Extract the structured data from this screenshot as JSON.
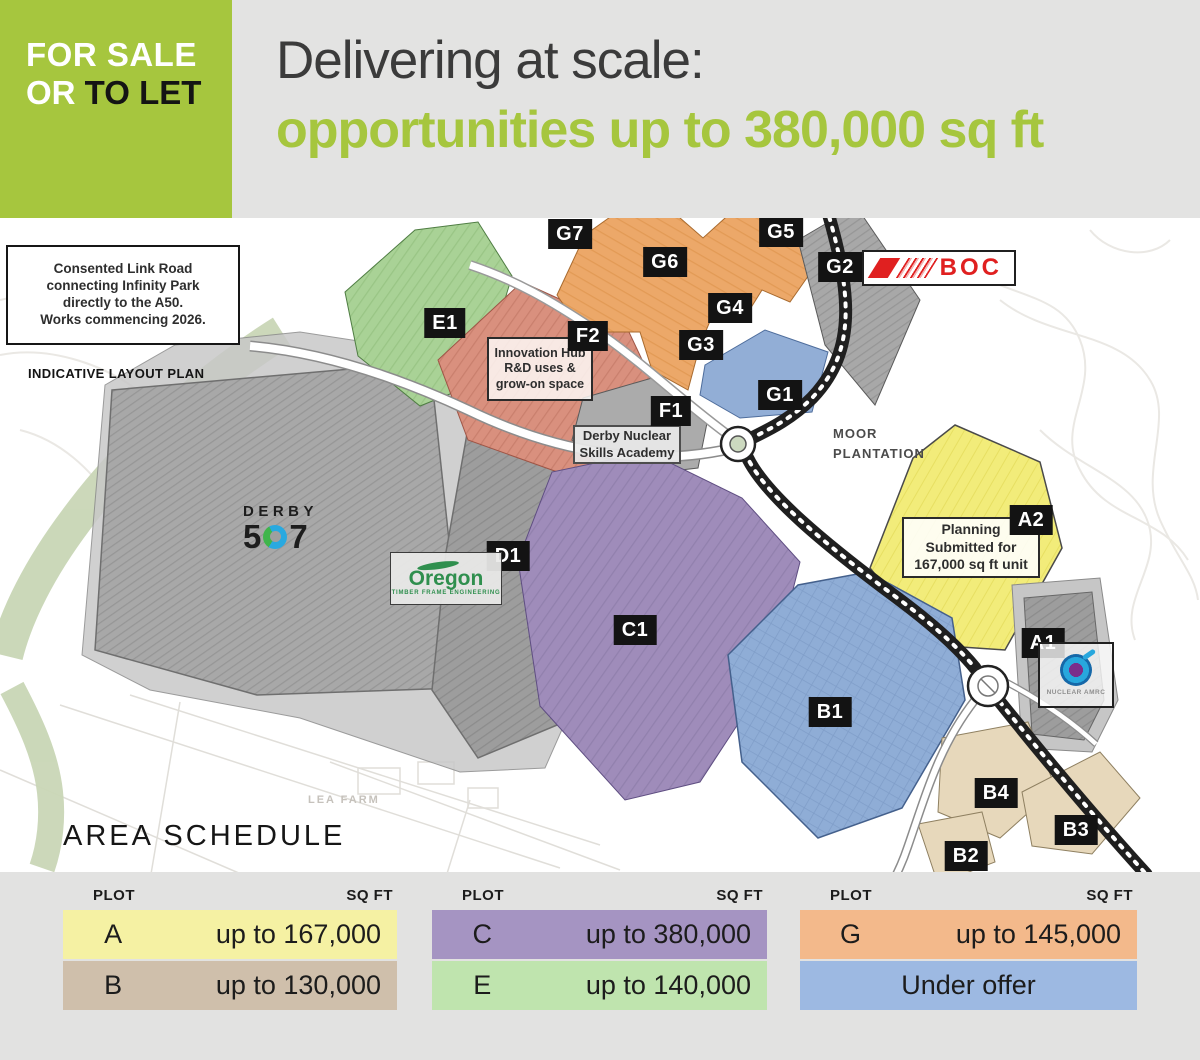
{
  "badge": {
    "for_sale": "FOR SALE",
    "or": "OR",
    "to_let": "TO LET"
  },
  "header": {
    "title": "Delivering at scale:",
    "subtitle": "opportunities up to 380,000 sq ft"
  },
  "map": {
    "note_lines": [
      "Consented Link Road",
      "connecting Infinity Park",
      "directly to the A50.",
      "Works commencing 2026."
    ],
    "plan_type_label": "INDICATIVE LAYOUT PLAN",
    "moor_plantation_lines": [
      "MOOR",
      "PLANTATION"
    ],
    "lea_farm": "LEA FARM",
    "innovation_lines": [
      "Innovation Hub",
      "R&D uses &",
      "grow-on space"
    ],
    "academy_lines": [
      "Derby Nuclear",
      "Skills Academy"
    ],
    "planning_lines": [
      "Planning",
      "Submitted for",
      "167,000 sq ft unit"
    ],
    "plots": {
      "e1": "E1",
      "f1": "F1",
      "f2": "F2",
      "g1": "G1",
      "g2": "G2",
      "g3": "G3",
      "g4": "G4",
      "g5": "G5",
      "g6": "G6",
      "g7": "G7",
      "a1": "A1",
      "a2": "A2",
      "b1": "B1",
      "b2": "B2",
      "b3": "B3",
      "b4": "B4",
      "c1": "C1",
      "d1": "D1"
    },
    "logos": {
      "boc": "BOC",
      "derby_word": "DERBY",
      "derby_5": "5",
      "derby_7": "7",
      "oregon_name": "Oregon",
      "oregon_tagline": "TIMBER FRAME ENGINEERING",
      "amrc_name": "NUCLEAR AMRC"
    }
  },
  "area_schedule": {
    "title": "AREA SCHEDULE",
    "plot_header": "PLOT",
    "sqft_header": "SQ FT",
    "rows": {
      "a": {
        "plot": "A",
        "value": "up to 167,000",
        "color": "#f5f1a3"
      },
      "b": {
        "plot": "B",
        "value": "up to 130,000",
        "color": "#cfbfab"
      },
      "c": {
        "plot": "C",
        "value": "up to 380,000",
        "color": "#a594c2"
      },
      "e": {
        "plot": "E",
        "value": "up to 140,000",
        "color": "#bfe4ae"
      },
      "g": {
        "plot": "G",
        "value": "up to 145,000",
        "color": "#f3b98b"
      },
      "under_offer": {
        "plot": "",
        "value": "Under offer",
        "color": "#9db9e2"
      }
    }
  },
  "colors": {
    "brand_lime": "#a6c63e",
    "header_gray": "#e3e3e2",
    "plot_yellow": "#f2ec7a",
    "plot_tan": "#e7d8bb",
    "plot_purple": "#9f8cba",
    "plot_green": "#a9d296",
    "plot_salmon": "#d9907e",
    "plot_orange": "#eca869",
    "plot_blue_under_offer": "#8fadd6",
    "plot_gray": "#a0a0a0",
    "boc_red": "#e02020"
  }
}
